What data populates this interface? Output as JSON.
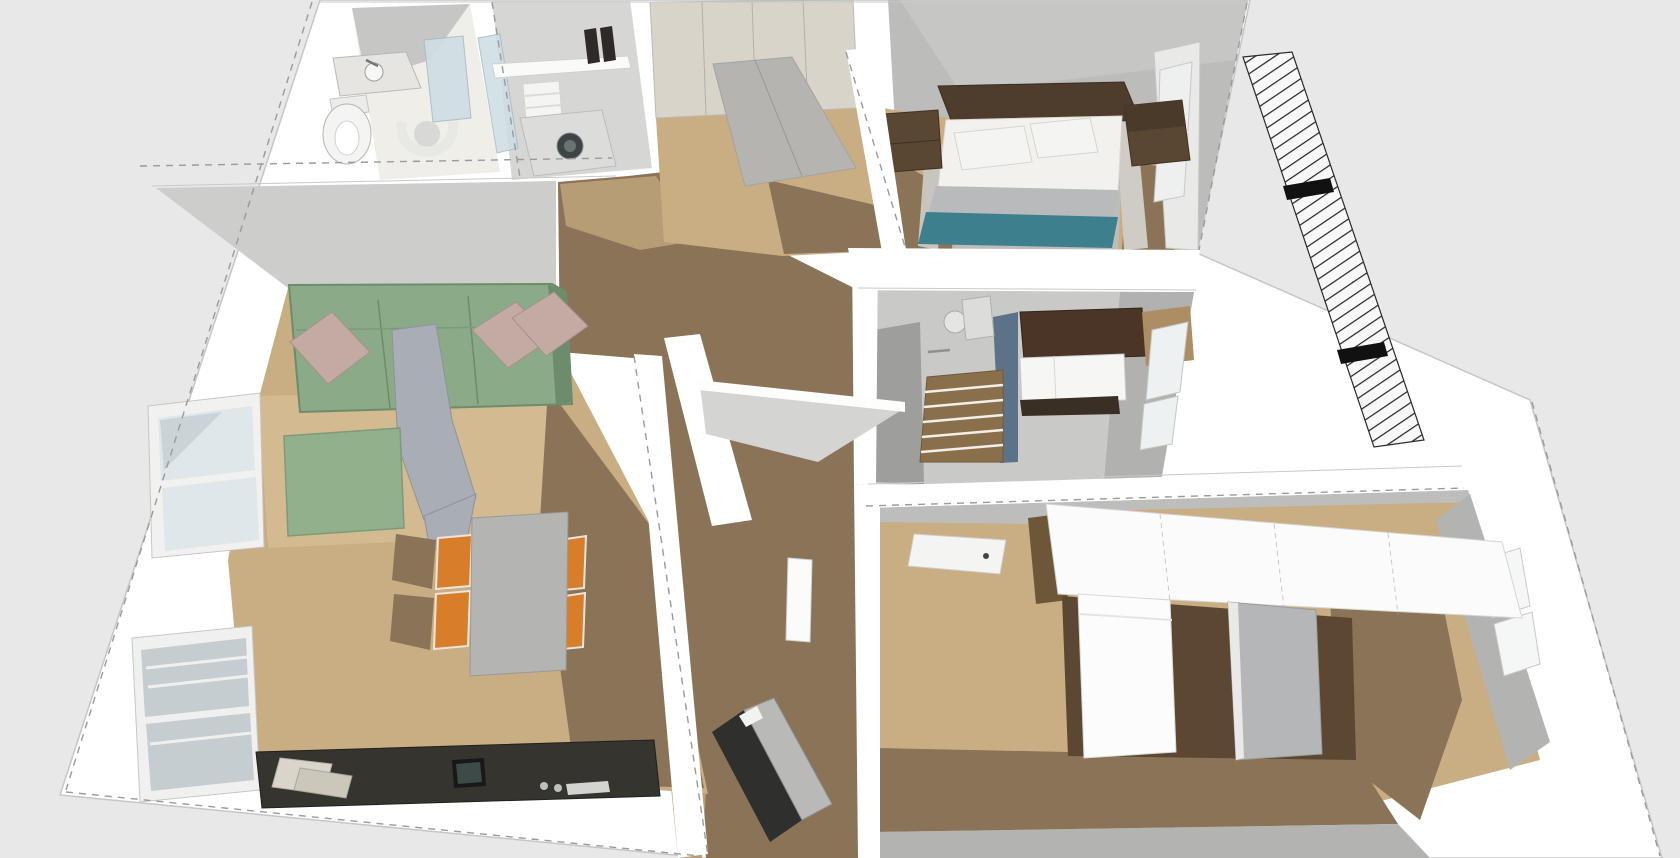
{
  "view": {
    "type": "axonometric-3d-floorplan-render",
    "style": "sketchup-white-model",
    "canvas": {
      "width": 1680,
      "height": 858
    }
  },
  "scene": {
    "rooms": [
      {
        "name": "living-room",
        "items": [
          "sofa",
          "cushions",
          "throw-blanket",
          "ottoman",
          "dining-table",
          "dining-chairs",
          "sideboard",
          "windows"
        ]
      },
      {
        "name": "wc",
        "items": [
          "washbasin",
          "toilet",
          "bidet",
          "glass-partition"
        ]
      },
      {
        "name": "laundry-room",
        "items": [
          "shelf",
          "towels",
          "shoes",
          "washing-machine"
        ]
      },
      {
        "name": "entry-hall",
        "items": [
          "wardrobe"
        ]
      },
      {
        "name": "bedroom",
        "items": [
          "double-bed",
          "headboard",
          "nightstand-left",
          "nightstand-right",
          "windows"
        ]
      },
      {
        "name": "bathroom",
        "items": [
          "shower",
          "duckboard",
          "vanity",
          "shelf",
          "windows"
        ]
      },
      {
        "name": "kitchen",
        "items": [
          "wall-cabinet-run",
          "counter",
          "refrigerator",
          "tall-appliance",
          "window"
        ]
      },
      {
        "name": "hallway",
        "items": [
          "leaning-board",
          "door"
        ]
      }
    ]
  },
  "colors": {
    "background": "#e8e8e8",
    "shell": "#ffffff",
    "ceiling": "#cdcdcb",
    "wall_grey": "#bcbcba",
    "tile": "#c9c9c7",
    "tile_dark": "#9e9e9c",
    "floor_oak": "#c9ad83",
    "floor_oak_light": "#d3ba90",
    "floor_oak_mid": "#b79d76",
    "floor_shadow": "#8a7356",
    "bottom_band": "#b3b3b1",
    "sofa": "#8aaa88",
    "sofa_edge": "#6d8c6b",
    "pouf": "#93b08d",
    "pillow": "#c3aaa2",
    "throw": "#a9adb5",
    "bed_white": "#f3f1ed",
    "bed_grey": "#b8babc",
    "bed_teal": "#3e7f8e",
    "headboard": "#4e3d2c",
    "nightstand": "#5a4733",
    "table": "#b4b4b2",
    "chair": "#d87e2a",
    "sideboard": "#35342f",
    "wardrobe": "#d8d4ca",
    "wardrobe_top": "#b6b4b0",
    "cabinet": "#fbfbfb",
    "counter_wood": "#6e5638",
    "fridge": "#fcfcfc",
    "appliance": "#b4b6b8",
    "appliance_dark": "#5c4832",
    "glass": "#cfdde4",
    "pane": "#dfe7ea",
    "pane_dark": "#c5cdd1",
    "shower_blue": "#5c7288",
    "duckboard": "#8a6f4b",
    "vanity_top": "#4a3526",
    "fixture": "#f4f4f2",
    "drum": "#3c4446",
    "shoe": "#2e2a28",
    "board_dark": "#2f2f2d",
    "board_grey": "#b9b9b7",
    "shelf_wood": "#ad8d63",
    "hatch_line": "#222222"
  }
}
